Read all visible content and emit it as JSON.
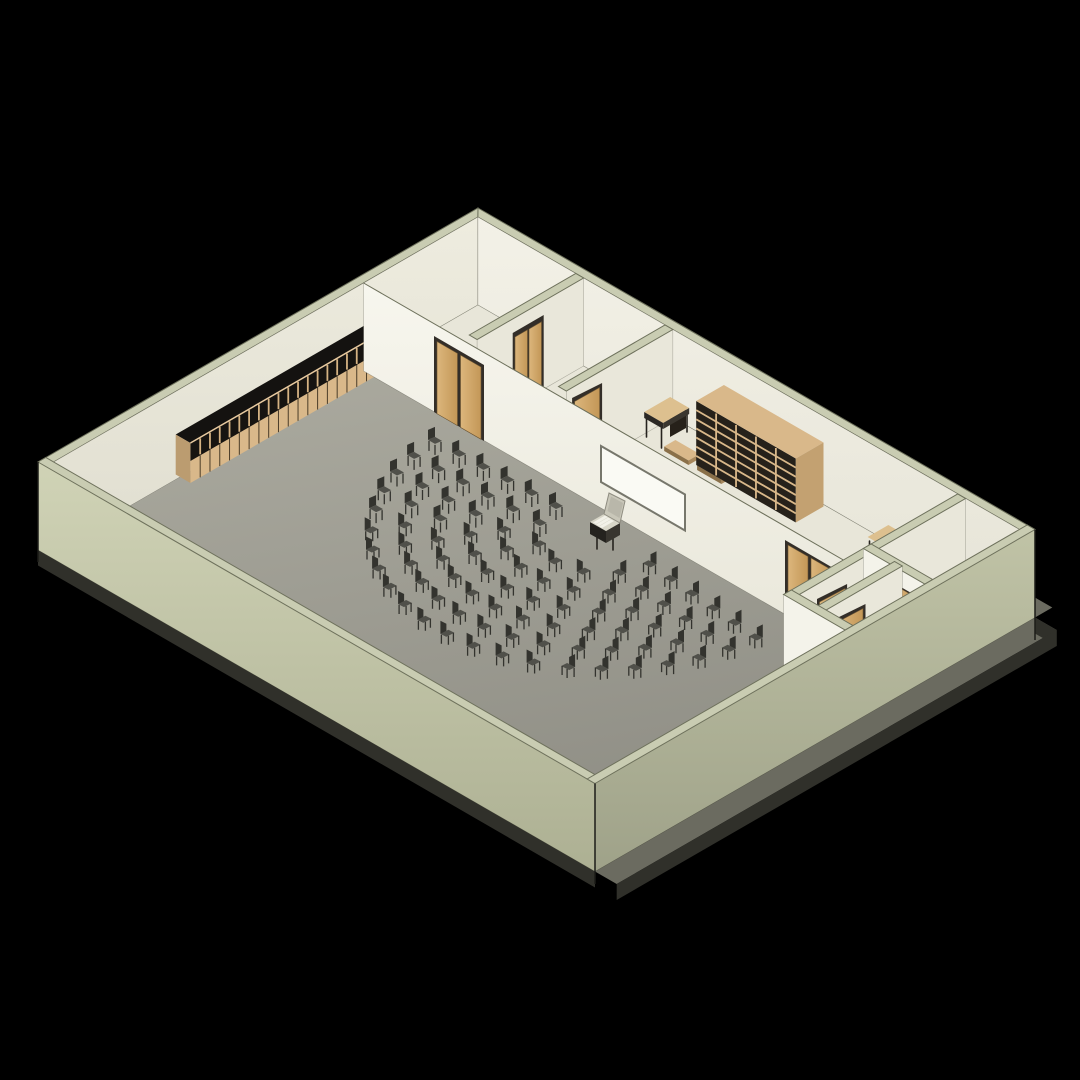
{
  "meta": {
    "title": "Isometric 3D floor-plan view of an assembly hall building",
    "render_style": "BIM axonometric cutaway on black background"
  },
  "palette": {
    "bg": "#000000",
    "wall_top": "#c9ccb2",
    "wall_edge": "#6e715c",
    "int_face_bright": "#f4f3ea",
    "int_face_shade": "#e9e7da",
    "floor_room": "#e8e6d9",
    "floor_hall": "#a09f95",
    "ramp": "#8f8e84",
    "ramp_edge": "#55544b",
    "ramp_curb": "#b9b8ad",
    "ext_wall_sw": "#c6c9ab",
    "ext_wall_se": "#b2b598",
    "slab_ledge": "#6b6b60",
    "slab_face": "#30302a",
    "door_frame": "#332e28",
    "door_wood": "#c99f63",
    "furn_wood": "#d9b88a",
    "furn_dark": "#26211a",
    "chair_dark": "#33332e",
    "chair_mid": "#50504a",
    "board_white": "#fafaf4",
    "lectern_light": "#d8d6c8"
  },
  "scene": {
    "building": {
      "storeys": 1,
      "footprint": "rectangular plate with cutaway walls",
      "view": "isometric from south-east above"
    },
    "rooms": [
      {
        "name": "assembly-hall",
        "floor": "grey",
        "features": [
          "semicircular chair rows",
          "lectern with open laptop",
          "locker run on north-west wall",
          "whiteboard",
          "ramp strip along south-west wall"
        ]
      },
      {
        "name": "office-north",
        "floor": "cream"
      },
      {
        "name": "office-middle",
        "floor": "cream"
      },
      {
        "name": "storage-corridor",
        "floor": "cream",
        "features": [
          "desk",
          "bookshelf",
          "benches",
          "side table"
        ]
      },
      {
        "name": "service-room-cluster-east",
        "small_rooms": 4,
        "floor": "cream"
      }
    ],
    "chair_arcs": {
      "rows": 6,
      "center_p": 333,
      "center_q": 322,
      "radii": [
        55,
        82,
        109,
        136,
        163,
        190
      ],
      "counts": [
        7,
        10,
        13,
        16,
        19,
        22
      ],
      "start_deg": 95,
      "end_deg": 268,
      "chairs_total": 87
    },
    "lockers": {
      "units": 20,
      "location": "north-west wall of hall"
    },
    "bookshelf": {
      "bays": 5,
      "shelf_rows": 7,
      "location": "storage corridor against north-east wall"
    },
    "furniture": {
      "chairs": 87,
      "lectern_with_laptop": 1,
      "whiteboard": 1,
      "desk": 1,
      "benches": 2,
      "side_table": 1,
      "locker_bays": 20
    },
    "doors": {
      "double": 3,
      "single": 4
    }
  }
}
